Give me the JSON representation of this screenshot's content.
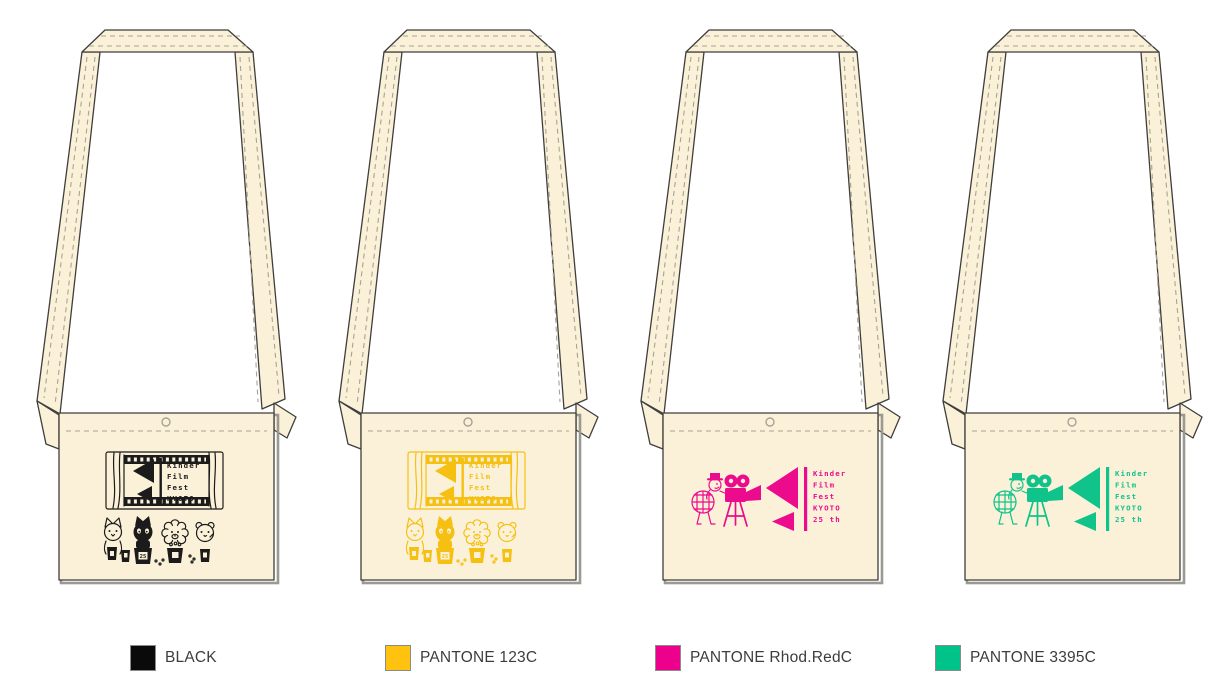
{
  "title": "Kinder Film Fest KYOTO shoulder-bag print color mockups",
  "colors": {
    "fabric": "#FBF1D8",
    "outline": "#3E3E3C",
    "stitch": "#A7A394",
    "shadow": "#9A9A92",
    "background": "#FFFFFF"
  },
  "logo": {
    "lines": [
      "Kinder",
      "Film",
      "Fest",
      "KYOTO",
      "25 th"
    ],
    "bucket_label": "25"
  },
  "bags": [
    {
      "id": "black",
      "design": "screen",
      "print_color": "#1B1B1B",
      "swatch": {
        "color": "#0A0A0A",
        "label": "BLACK"
      }
    },
    {
      "id": "pantone-123c",
      "design": "screen",
      "print_color": "#F6C013",
      "swatch": {
        "color": "#FFC20E",
        "label": "PANTONE 123C"
      }
    },
    {
      "id": "pantone-rhod-red-c",
      "design": "camera",
      "print_color": "#EC0B8C",
      "swatch": {
        "color": "#EC008C",
        "label": "PANTONE Rhod.RedC"
      }
    },
    {
      "id": "pantone-3395c",
      "design": "camera",
      "print_color": "#10C38B",
      "swatch": {
        "color": "#00C389",
        "label": "PANTONE 3395C"
      }
    }
  ]
}
